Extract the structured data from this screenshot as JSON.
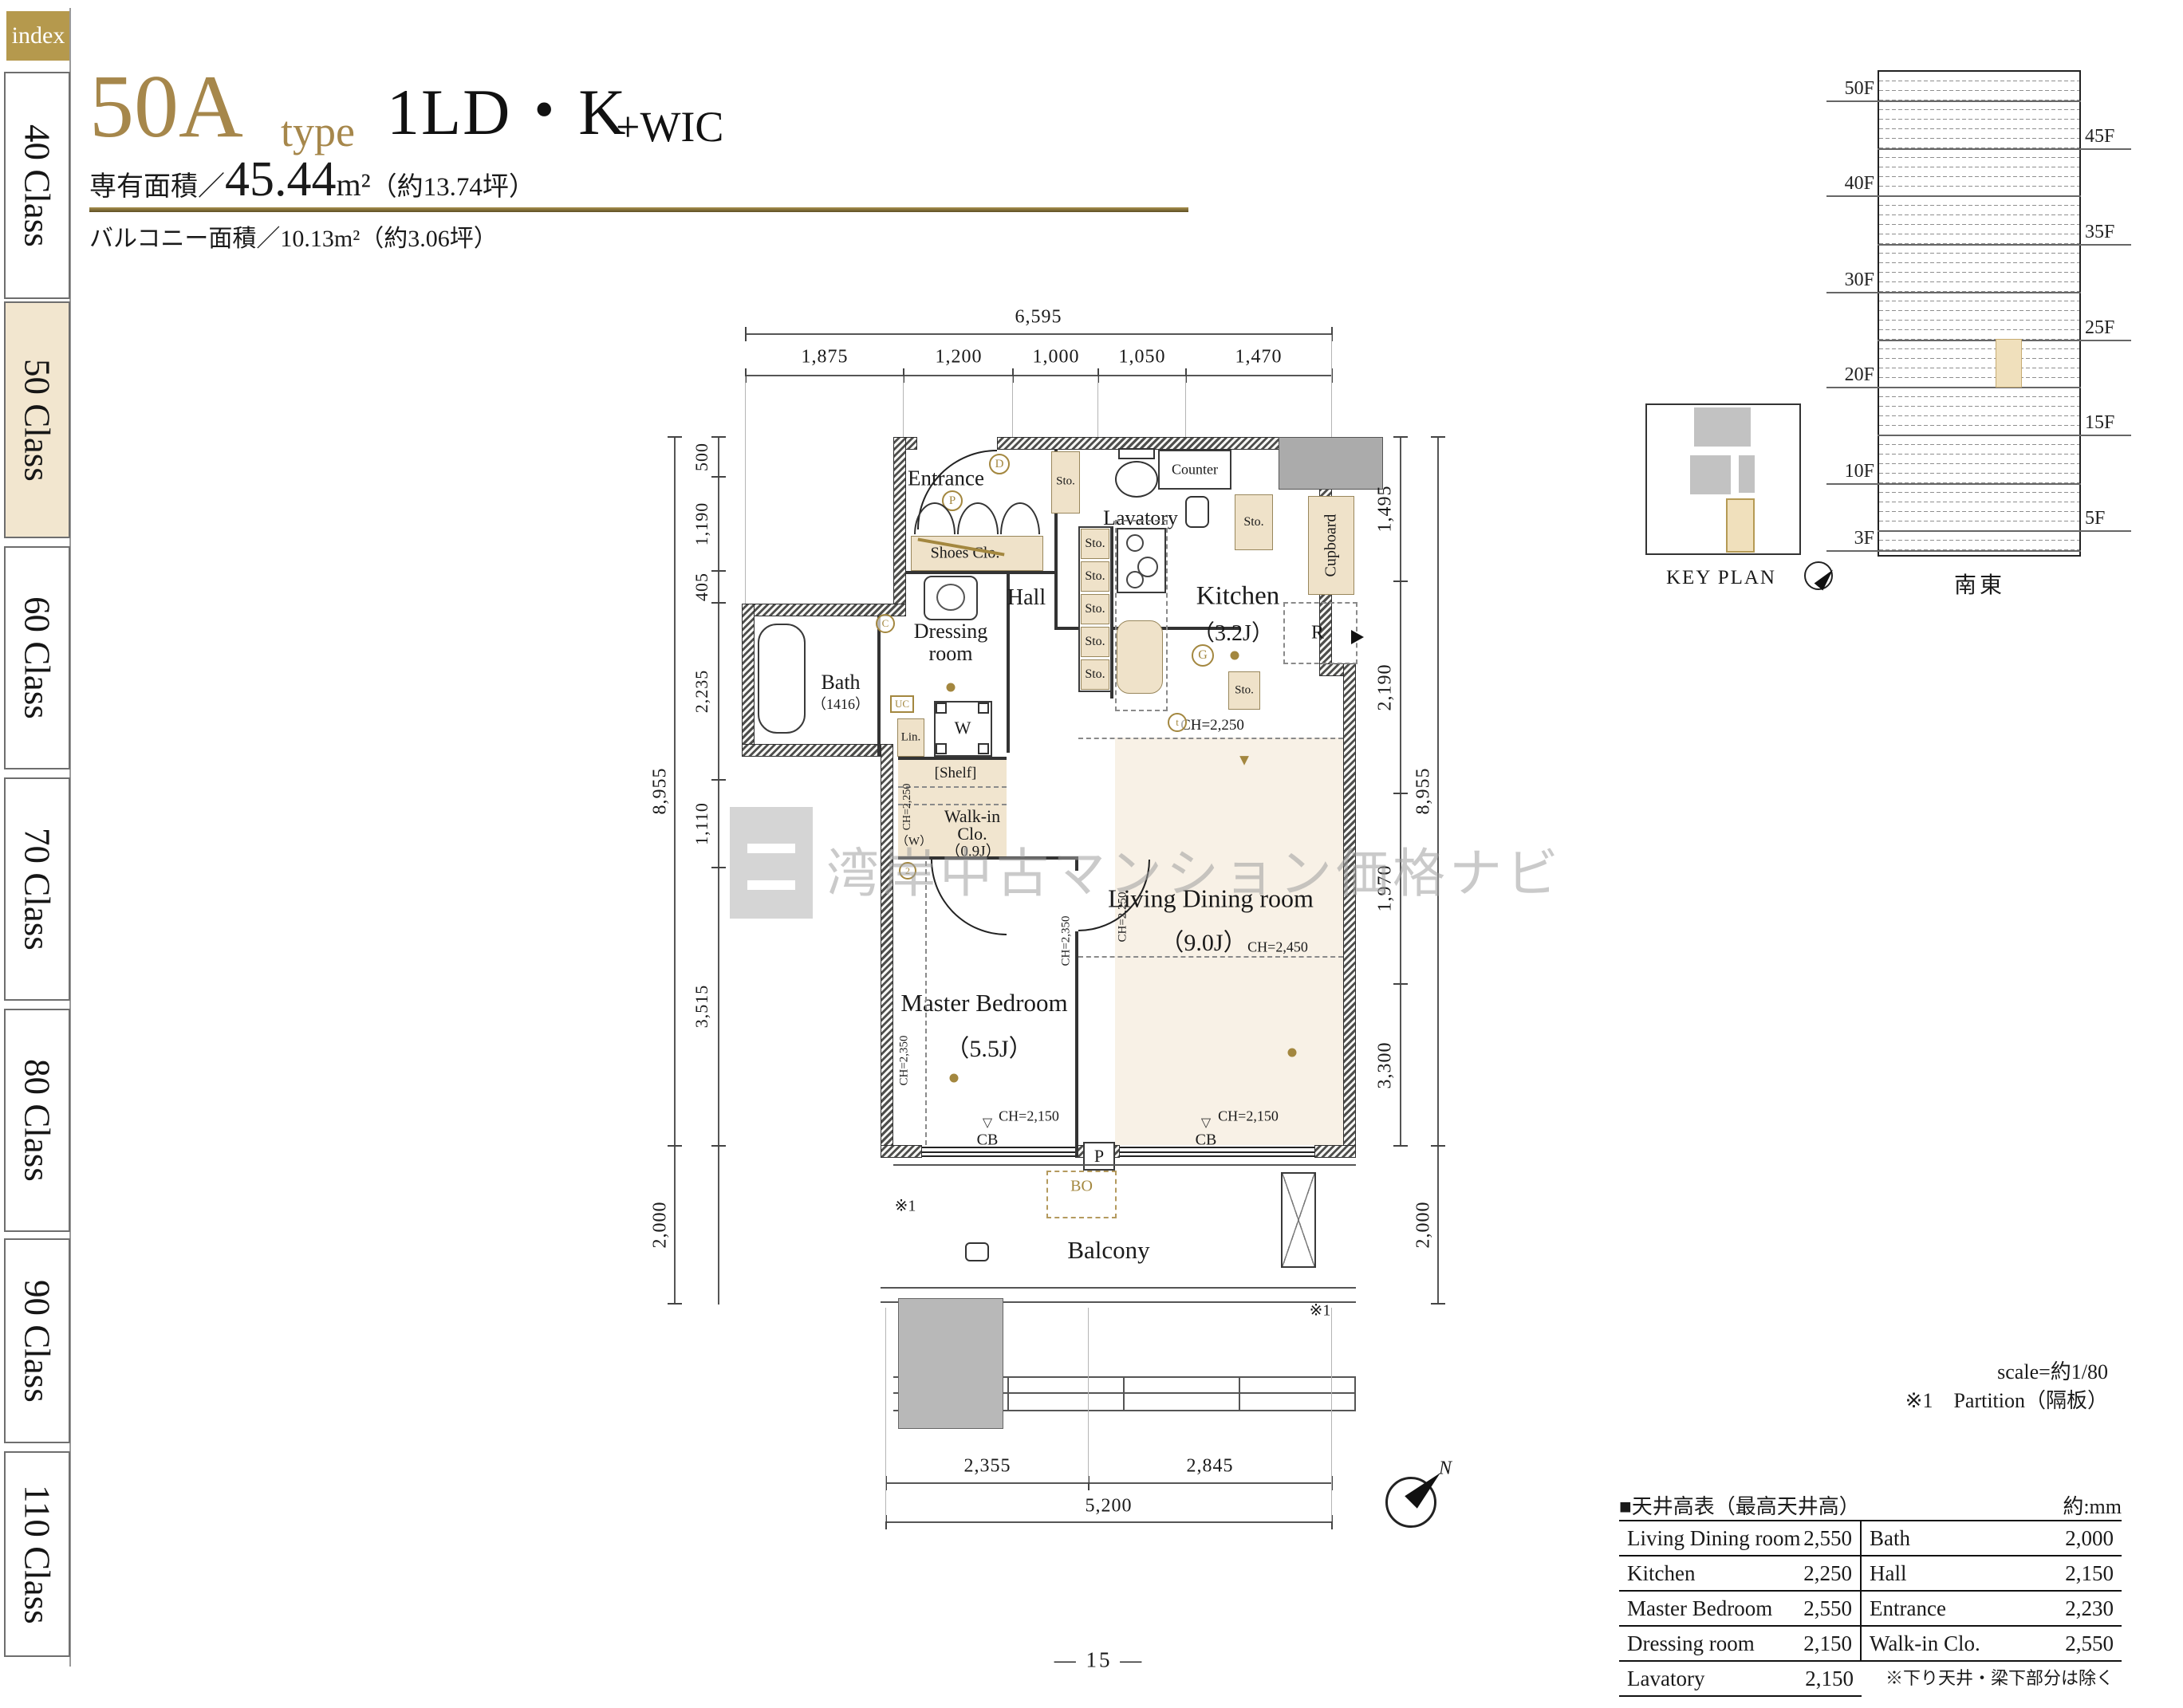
{
  "sidebar": {
    "index": "index",
    "tabs": [
      "40 Class",
      "50 Class",
      "60 Class",
      "70 Class",
      "80 Class",
      "90 Class",
      "110 Class"
    ],
    "active_tab": "50 Class"
  },
  "header": {
    "type_code": "50A",
    "type_word": "type",
    "plan_name": "1LD・K",
    "plan_suffix": "+WIC",
    "area_label": "専有面積／",
    "area_value": "45.44",
    "area_unit": "m²",
    "area_note": "（約13.74坪）",
    "balcony_line": "バルコニー面積／10.13m²（約3.06坪）"
  },
  "elevation": {
    "left_floors": [
      "50F",
      "40F",
      "30F",
      "20F",
      "10F",
      "3F"
    ],
    "right_floors": [
      "45F",
      "35F",
      "25F",
      "15F",
      "5F"
    ],
    "direction": "南東"
  },
  "key_plan": {
    "title": "KEY PLAN"
  },
  "floor_plan": {
    "rooms": {
      "entrance": "Entrance",
      "lavatory": "Lavatory",
      "kitchen": "Kitchen",
      "kitchen_size": "（3.2J）",
      "hall": "Hall",
      "dressing_1": "Dressing",
      "dressing_2": "room",
      "bath": "Bath",
      "bath_size": "（1416）",
      "wic_1": "Walk-in",
      "wic_2": "Clo.",
      "wic_size": "（0.9J）",
      "wic_w": "（W）",
      "living": "Living Dining room",
      "living_size": "（9.0J）",
      "bedroom": "Master Bedroom",
      "bedroom_size": "（5.5J）",
      "balcony": "Balcony"
    },
    "fixtures": {
      "sto": "Sto.",
      "shoes": "Shoes Clo.",
      "counter": "Counter",
      "cupboard": "Cupboard",
      "shelf": "[Shelf]",
      "linen": "Lin.",
      "washer": "W",
      "uc": "UC",
      "fridge": "R",
      "bo": "BO",
      "p": "P",
      "cb": "CB",
      "note1": "※1",
      "g": "G",
      "d": "D",
      "c": "C",
      "t": "t"
    },
    "ch": {
      "c2150": "CH=2,150",
      "c2250": "CH=2,250",
      "c2350": "CH=2,350",
      "c2450": "CH=2,450"
    },
    "dims": {
      "top_total": "6,595",
      "top": [
        "1,875",
        "1,200",
        "1,000",
        "1,050",
        "1,470"
      ],
      "left_inner": [
        "500",
        "1,190",
        "405",
        "2,235",
        "1,110",
        "3,515"
      ],
      "left_outer": [
        "8,955",
        "2,000"
      ],
      "right_inner": [
        "1,495",
        "2,190",
        "1,970",
        "3,300"
      ],
      "right_outer": [
        "8,955",
        "2,000"
      ],
      "bottom": [
        "2,355",
        "2,845"
      ],
      "bottom_total": "5,200"
    },
    "compass_n": "N"
  },
  "notes": {
    "scale": "scale=約1/80",
    "partition": "※1　Partition（隔板）"
  },
  "ceiling_table": {
    "title": "■天井高表（最高天井高）",
    "unit": "約:mm",
    "rows": [
      [
        "Living Dining room",
        "2,550",
        "Bath",
        "2,000"
      ],
      [
        "Kitchen",
        "2,250",
        "Hall",
        "2,150"
      ],
      [
        "Master Bedroom",
        "2,550",
        "Entrance",
        "2,230"
      ],
      [
        "Dressing room",
        "2,150",
        "Walk-in Clo.",
        "2,550"
      ],
      [
        "Lavatory",
        "2,150",
        "",
        ""
      ]
    ],
    "footnote": "※下り天井・梁下部分は除く"
  },
  "watermark": {
    "text": "湾岸中古マンション価格ナビ"
  },
  "page": {
    "number": "— 15 —"
  }
}
